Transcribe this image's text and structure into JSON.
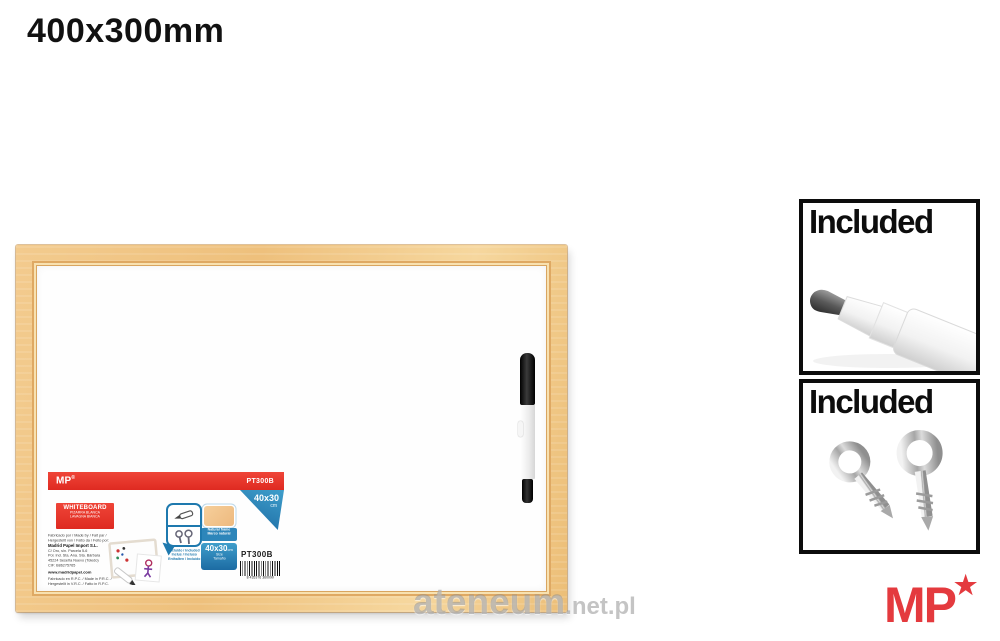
{
  "page": {
    "title": "400x300mm"
  },
  "watermark": {
    "main": "ateneum",
    "suffix": ".net.pl"
  },
  "logo": {
    "text": "MP",
    "star": "★"
  },
  "included_panels": [
    {
      "label": "Included",
      "content": "marker-tip-photo"
    },
    {
      "label": "Included",
      "content": "eye-hooks-photo"
    }
  ],
  "colors": {
    "accent_red": "#e73128",
    "accent_blue": "#2580b5",
    "wood_frame": "#f0c17f",
    "logo_red": "#e43a3e"
  },
  "label": {
    "banner": {
      "brand": "MP",
      "reg": "®",
      "sku": "PT300B"
    },
    "flag": {
      "size": "40x30",
      "unit": "cm"
    },
    "product": {
      "title": "WHITEBOARD",
      "sub1": "PIZARRA BLANCA",
      "sub2": "LAVAGNA BIANCA"
    },
    "maker": {
      "made1": "Fabricado por / Made by / Fait par /",
      "made2": "Hergestellt von / Fatto da / Feito por:",
      "company": "Madrid Papel Import S.L.",
      "addr1": "C/ Oro, s/n. Parcela 5-6",
      "addr2": "Pol. Ind. Sta. Ana. Sta. Bárbara",
      "addr3": "45224 Seseña Nuevo (Toledo)",
      "addr4": "CIF: B86275765",
      "web": "www.madridpapel.com",
      "foot1": "Fabricado en R.P.C. / Made in P.R.C. /",
      "foot2": "Hergestellt in V.R.C. / Fatto in R.P.C."
    },
    "bubble": {
      "cap1": "Incluido / Included",
      "cap2": "Inclus / Incluso",
      "cap3": "Enthalten / Incluído"
    },
    "sample": {
      "cap1": "Natural frame",
      "cap2": "Marco natural"
    },
    "sizebox": {
      "size": "40x30",
      "unit": "cm",
      "sub1": "Size",
      "sub2": "Tamaño"
    },
    "sku": "PT300B",
    "barcode": "8 435376 360090"
  }
}
